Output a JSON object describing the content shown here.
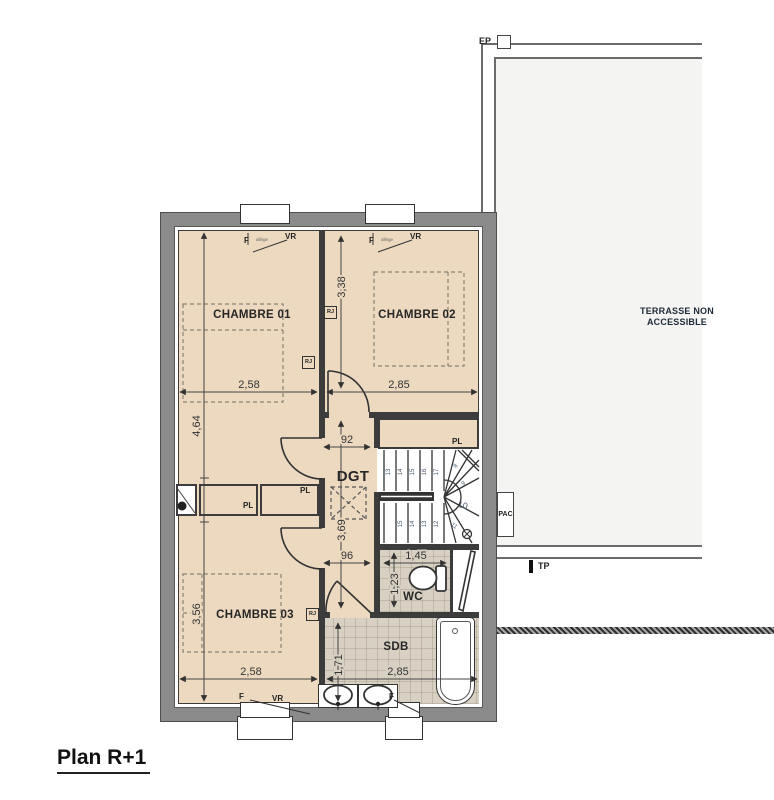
{
  "title": "Plan R+1",
  "terrace": {
    "label": "TERRASSE NON ACCESSIBLE",
    "ep": "EP",
    "tp": "TP",
    "pac": "PAC"
  },
  "rooms": {
    "ch01": "CHAMBRE 01",
    "ch02": "CHAMBRE 02",
    "ch03": "CHAMBRE 03",
    "dgt": "DGT",
    "wc": "WC",
    "sdb": "SDB",
    "pl": "PL"
  },
  "annotations": {
    "vr": "VR",
    "f": "F",
    "rj": "RJ",
    "allege": "allège"
  },
  "dims": {
    "ch02_depth": "3,38",
    "ch01_width": "2,58",
    "ch02_width": "2,85",
    "left_depth": "4,64",
    "hall_width_top": "92",
    "hall_length": "3,69",
    "hall_width_bottom": "96",
    "wc_width": "1,45",
    "wc_depth": "1,23",
    "ch03_depth": "3,56",
    "ch03_width": "2,58",
    "sdb_width": "2,85",
    "sdb_depth": "1,71"
  },
  "stairs": {
    "numbers": [
      "13",
      "14",
      "15",
      "16",
      "17",
      "8",
      "9",
      "10",
      "11",
      "12",
      "13",
      "14",
      "15"
    ]
  },
  "colors": {
    "room_fill": "#ecd9bf",
    "tile_fill": "#d8d0c3",
    "wall_gray": "#8b8b8b",
    "partition": "#3c3c3c",
    "terrace_fill": "#f4f4f2"
  }
}
